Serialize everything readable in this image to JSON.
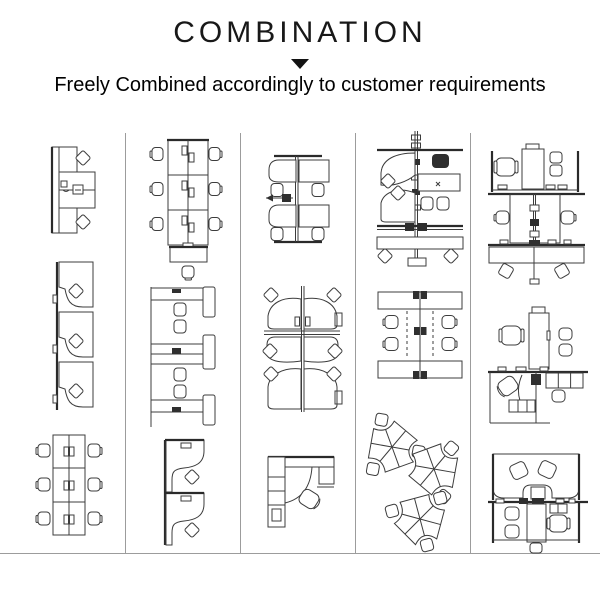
{
  "header": {
    "title": "COMBINATION",
    "arrow_icon": "triangle-down",
    "subtitle": "Freely Combined accordingly to customer requirements"
  },
  "colors": {
    "background": "#ffffff",
    "text": "#111111",
    "drawing_line": "#3c3c3c",
    "panel_line": "#2a2a2a",
    "divider": "#9c9c9c"
  },
  "grid": {
    "column_count": 5,
    "columns": [
      {
        "drawings": [
          {
            "name": "plan-2-person-face-to-face-desk-with-panel"
          },
          {
            "name": "plan-3-person-inline-l-desks-on-panel"
          },
          {
            "name": "plan-6-person-bench-cluster"
          }
        ]
      },
      {
        "drawings": [
          {
            "name": "plan-6-person-bench-with-spine-and-end-table"
          },
          {
            "name": "plan-4-person-inline-desks-with-side-cabinets"
          },
          {
            "name": "plan-2-person-stacked-l-desks"
          }
        ]
      },
      {
        "drawings": [
          {
            "name": "plan-4-person-spine-cluster"
          },
          {
            "name": "plan-6-person-curved-desk-cluster"
          },
          {
            "name": "plan-single-l-desk-with-storage"
          }
        ]
      },
      {
        "drawings": [
          {
            "name": "plan-6-person-mixed-spine-cluster"
          },
          {
            "name": "plan-4-person-double-row-with-spine"
          },
          {
            "name": "plan-3-pod-120-degree-cluster"
          }
        ]
      },
      {
        "drawings": [
          {
            "name": "plan-6-person-manager-combination"
          },
          {
            "name": "plan-executive-desk-with-guest-chairs-and-storage"
          },
          {
            "name": "plan-4-person-u-desk-manager-combination"
          }
        ]
      }
    ]
  }
}
